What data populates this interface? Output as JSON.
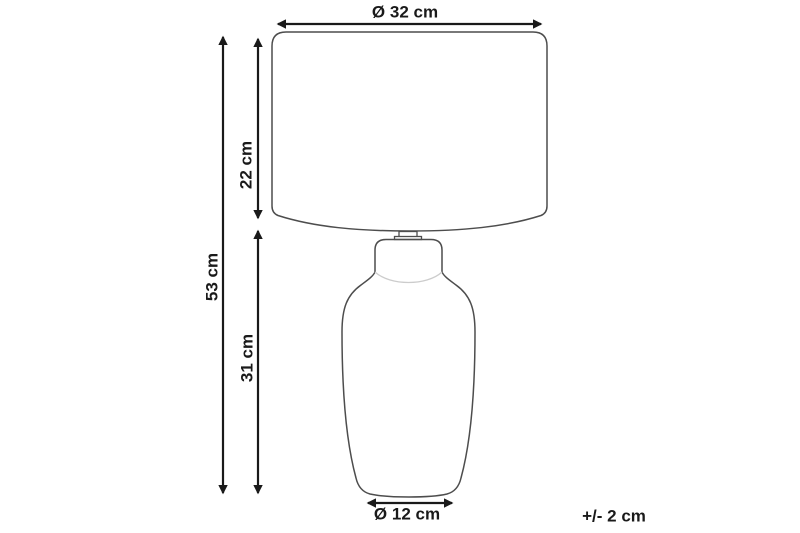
{
  "diagram": {
    "labels": {
      "shade_diameter": "Ø 32 cm",
      "shade_height": "22 cm",
      "total_height": "53 cm",
      "body_height": "31 cm",
      "base_diameter": "Ø 12 cm",
      "tolerance": "+/- 2 cm"
    },
    "colors": {
      "dimension_color": "#1a1a1a",
      "outline_color": "#4d4d4d",
      "outline_light_color": "#cccccc",
      "background": "#ffffff"
    }
  }
}
